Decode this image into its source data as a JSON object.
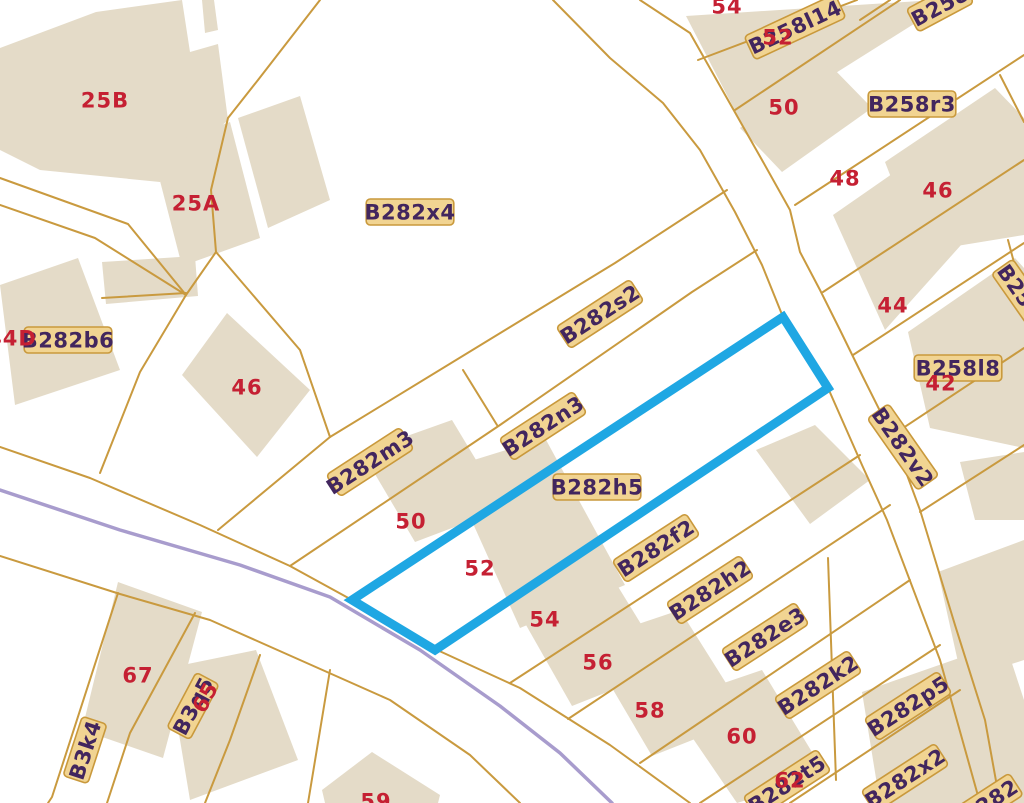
{
  "map": {
    "colors": {
      "background": "#ffffff",
      "building_fill": "#e4dbc8",
      "parcel_line": "#c99a3f",
      "stream_line": "#a89ccd",
      "selection_stroke": "#1fa7e3",
      "house_number": "#c52033",
      "label_text": "#42265e",
      "label_bg": "#f1d492",
      "label_border": "#c9993c"
    },
    "selection_outline": [
      [
        352,
        600
      ],
      [
        783,
        317
      ],
      [
        828,
        388
      ],
      [
        435,
        650
      ]
    ],
    "stream_path": [
      [
        0,
        490
      ],
      [
        120,
        530
      ],
      [
        240,
        565
      ],
      [
        330,
        597
      ],
      [
        420,
        650
      ],
      [
        500,
        706
      ],
      [
        560,
        753
      ],
      [
        612,
        803
      ]
    ],
    "parcel_lines": [
      [
        [
          553,
          0
        ],
        [
          610,
          58
        ],
        [
          663,
          103
        ],
        [
          700,
          150
        ],
        [
          735,
          212
        ],
        [
          762,
          265
        ],
        [
          783,
          317
        ]
      ],
      [
        [
          828,
          388
        ],
        [
          862,
          465
        ],
        [
          887,
          520
        ],
        [
          940,
          660
        ],
        [
          968,
          760
        ],
        [
          980,
          803
        ]
      ],
      [
        [
          640,
          0
        ],
        [
          690,
          33
        ],
        [
          762,
          160
        ],
        [
          790,
          210
        ],
        [
          800,
          252
        ],
        [
          820,
          290
        ],
        [
          840,
          330
        ],
        [
          863,
          377
        ],
        [
          893,
          437
        ],
        [
          920,
          510
        ],
        [
          955,
          625
        ],
        [
          985,
          720
        ],
        [
          1000,
          803
        ]
      ],
      [
        [
          0,
          447
        ],
        [
          90,
          478
        ],
        [
          200,
          525
        ],
        [
          290,
          566
        ],
        [
          352,
          600
        ],
        [
          435,
          649
        ],
        [
          520,
          688
        ],
        [
          610,
          745
        ],
        [
          690,
          803
        ]
      ],
      [
        [
          0,
          556
        ],
        [
          120,
          594
        ],
        [
          210,
          620
        ],
        [
          300,
          660
        ],
        [
          390,
          700
        ],
        [
          470,
          755
        ],
        [
          520,
          803
        ]
      ],
      [
        [
          320,
          0
        ],
        [
          258,
          80
        ],
        [
          228,
          118
        ],
        [
          211,
          190
        ],
        [
          216,
          252
        ],
        [
          186,
          295
        ],
        [
          140,
          372
        ],
        [
          100,
          473
        ]
      ],
      [
        [
          0,
          178
        ],
        [
          128,
          224
        ],
        [
          186,
          295
        ]
      ],
      [
        [
          0,
          205
        ],
        [
          95,
          238
        ],
        [
          186,
          295
        ]
      ],
      [
        [
          102,
          298
        ],
        [
          186,
          293
        ]
      ],
      [
        [
          218,
          530
        ],
        [
          330,
          437
        ],
        [
          615,
          263
        ],
        [
          727,
          190
        ]
      ],
      [
        [
          290,
          566
        ],
        [
          500,
          425
        ],
        [
          692,
          292
        ],
        [
          757,
          250
        ]
      ],
      [
        [
          463,
          370
        ],
        [
          497,
          425
        ]
      ],
      [
        [
          216,
          252
        ],
        [
          300,
          350
        ],
        [
          330,
          437
        ]
      ],
      [
        [
          510,
          683
        ],
        [
          860,
          455
        ]
      ],
      [
        [
          568,
          719
        ],
        [
          890,
          505
        ]
      ],
      [
        [
          640,
          763
        ],
        [
          910,
          580
        ]
      ],
      [
        [
          700,
          803
        ],
        [
          940,
          645
        ]
      ],
      [
        [
          790,
          803
        ],
        [
          960,
          690
        ]
      ],
      [
        [
          828,
          558
        ],
        [
          836,
          780
        ]
      ],
      [
        [
          860,
          20
        ],
        [
          890,
          0
        ]
      ],
      [
        [
          735,
          110
        ],
        [
          900,
          0
        ]
      ],
      [
        [
          698,
          60
        ],
        [
          857,
          0
        ]
      ],
      [
        [
          795,
          205
        ],
        [
          1024,
          55
        ]
      ],
      [
        [
          823,
          292
        ],
        [
          1024,
          160
        ]
      ],
      [
        [
          853,
          355
        ],
        [
          1024,
          243
        ]
      ],
      [
        [
          888,
          438
        ],
        [
          1024,
          348
        ]
      ],
      [
        [
          920,
          512
        ],
        [
          1024,
          445
        ]
      ],
      [
        [
          118,
          593
        ],
        [
          52,
          797
        ],
        [
          48,
          803
        ]
      ],
      [
        [
          195,
          613
        ],
        [
          130,
          733
        ],
        [
          107,
          803
        ]
      ],
      [
        [
          260,
          655
        ],
        [
          230,
          740
        ],
        [
          205,
          803
        ]
      ],
      [
        [
          330,
          670
        ],
        [
          308,
          803
        ]
      ],
      [
        [
          1000,
          75
        ],
        [
          1024,
          122
        ]
      ],
      [
        [
          1008,
          240
        ],
        [
          1024,
          300
        ]
      ]
    ],
    "buildings": [
      [
        [
          0,
          48
        ],
        [
          96,
          12
        ],
        [
          182,
          0
        ],
        [
          190,
          52
        ],
        [
          218,
          44
        ],
        [
          228,
          120
        ],
        [
          160,
          182
        ],
        [
          40,
          170
        ],
        [
          0,
          150
        ]
      ],
      [
        [
          202,
          0
        ],
        [
          214,
          0
        ],
        [
          218,
          30
        ],
        [
          205,
          33
        ]
      ],
      [
        [
          152,
          150
        ],
        [
          230,
          122
        ],
        [
          260,
          238
        ],
        [
          182,
          266
        ]
      ],
      [
        [
          238,
          118
        ],
        [
          300,
          96
        ],
        [
          330,
          200
        ],
        [
          268,
          228
        ]
      ],
      [
        [
          0,
          285
        ],
        [
          78,
          258
        ],
        [
          120,
          370
        ],
        [
          15,
          405
        ]
      ],
      [
        [
          102,
          262
        ],
        [
          195,
          256
        ],
        [
          198,
          296
        ],
        [
          106,
          304
        ]
      ],
      [
        [
          227,
          313
        ],
        [
          310,
          390
        ],
        [
          257,
          457
        ],
        [
          182,
          375
        ]
      ],
      [
        [
          362,
          452
        ],
        [
          452,
          420
        ],
        [
          505,
          508
        ],
        [
          415,
          542
        ]
      ],
      [
        [
          448,
          468
        ],
        [
          545,
          438
        ],
        [
          625,
          585
        ],
        [
          520,
          628
        ]
      ],
      [
        [
          505,
          588
        ],
        [
          598,
          554
        ],
        [
          668,
          668
        ],
        [
          572,
          706
        ]
      ],
      [
        [
          585,
          642
        ],
        [
          680,
          610
        ],
        [
          748,
          718
        ],
        [
          652,
          756
        ]
      ],
      [
        [
          668,
          702
        ],
        [
          762,
          670
        ],
        [
          826,
          775
        ],
        [
          737,
          803
        ]
      ],
      [
        [
          756,
          450
        ],
        [
          815,
          425
        ],
        [
          870,
          480
        ],
        [
          810,
          524
        ]
      ],
      [
        [
          686,
          16
        ],
        [
          935,
          0
        ],
        [
          952,
          0
        ],
        [
          745,
          130
        ]
      ],
      [
        [
          740,
          128
        ],
        [
          830,
          65
        ],
        [
          872,
          108
        ],
        [
          782,
          172
        ]
      ],
      [
        [
          885,
          162
        ],
        [
          995,
          88
        ],
        [
          1024,
          118
        ],
        [
          1024,
          235
        ],
        [
          920,
          252
        ]
      ],
      [
        [
          833,
          215
        ],
        [
          958,
          128
        ],
        [
          1012,
          188
        ],
        [
          885,
          330
        ]
      ],
      [
        [
          908,
          332
        ],
        [
          1015,
          258
        ],
        [
          1024,
          268
        ],
        [
          1024,
          448
        ],
        [
          930,
          428
        ]
      ],
      [
        [
          960,
          462
        ],
        [
          1024,
          452
        ],
        [
          1024,
          520
        ],
        [
          975,
          520
        ]
      ],
      [
        [
          938,
          572
        ],
        [
          1024,
          540
        ],
        [
          1024,
          660
        ],
        [
          962,
          680
        ]
      ],
      [
        [
          862,
          692
        ],
        [
          1005,
          642
        ],
        [
          1024,
          700
        ],
        [
          1024,
          803
        ],
        [
          880,
          803
        ]
      ],
      [
        [
          118,
          582
        ],
        [
          202,
          612
        ],
        [
          163,
          758
        ],
        [
          82,
          730
        ]
      ],
      [
        [
          168,
          668
        ],
        [
          256,
          650
        ],
        [
          298,
          760
        ],
        [
          190,
          800
        ]
      ],
      [
        [
          322,
          790
        ],
        [
          372,
          752
        ],
        [
          440,
          795
        ],
        [
          438,
          803
        ],
        [
          325,
          803
        ]
      ]
    ],
    "parcel_labels": [
      {
        "text": "B282x4",
        "x": 410,
        "y": 212,
        "rot": 0
      },
      {
        "text": "B282s2",
        "x": 600,
        "y": 314,
        "rot": -33
      },
      {
        "text": "B282n3",
        "x": 543,
        "y": 426,
        "rot": -33
      },
      {
        "text": "B282m3",
        "x": 370,
        "y": 462,
        "rot": -33
      },
      {
        "text": "B282h5",
        "x": 597,
        "y": 487,
        "rot": 0
      },
      {
        "text": "B282f2",
        "x": 656,
        "y": 548,
        "rot": -33
      },
      {
        "text": "B282h2",
        "x": 710,
        "y": 590,
        "rot": -33
      },
      {
        "text": "B282e3",
        "x": 765,
        "y": 637,
        "rot": -33
      },
      {
        "text": "B282k2",
        "x": 818,
        "y": 685,
        "rot": -33
      },
      {
        "text": "B282p5",
        "x": 908,
        "y": 706,
        "rot": -33
      },
      {
        "text": "B282x2",
        "x": 905,
        "y": 778,
        "rot": -33
      },
      {
        "text": "B282t5",
        "x": 787,
        "y": 784,
        "rot": -33
      },
      {
        "text": "B282b6",
        "x": 68,
        "y": 340,
        "rot": 0
      },
      {
        "text": "B282v2",
        "x": 903,
        "y": 447,
        "rot": 55
      },
      {
        "text": "B258l14",
        "x": 795,
        "y": 27,
        "rot": -25
      },
      {
        "text": "B258r3",
        "x": 912,
        "y": 104,
        "rot": 0
      },
      {
        "text": "B258l8",
        "x": 958,
        "y": 368,
        "rot": 0
      },
      {
        "text": "B258",
        "x": 940,
        "y": 6,
        "rot": -28
      },
      {
        "text": "B258",
        "x": 1020,
        "y": 292,
        "rot": 55
      },
      {
        "text": "B282",
        "x": 990,
        "y": 801,
        "rot": -33
      },
      {
        "text": "B3k4",
        "x": 85,
        "y": 750,
        "rot": -72
      },
      {
        "text": "B3q5",
        "x": 193,
        "y": 706,
        "rot": -62
      }
    ],
    "house_numbers": [
      {
        "text": "25B",
        "x": 105,
        "y": 100,
        "rot": 0
      },
      {
        "text": "25A",
        "x": 196,
        "y": 203,
        "rot": 0
      },
      {
        "text": "44D",
        "x": 12,
        "y": 338,
        "rot": 0
      },
      {
        "text": "46",
        "x": 247,
        "y": 387,
        "rot": 0
      },
      {
        "text": "50",
        "x": 411,
        "y": 521,
        "rot": 0
      },
      {
        "text": "52",
        "x": 480,
        "y": 568,
        "rot": 0
      },
      {
        "text": "54",
        "x": 545,
        "y": 619,
        "rot": 0
      },
      {
        "text": "56",
        "x": 598,
        "y": 662,
        "rot": 0
      },
      {
        "text": "58",
        "x": 650,
        "y": 710,
        "rot": 0
      },
      {
        "text": "60",
        "x": 742,
        "y": 736,
        "rot": 0
      },
      {
        "text": "62",
        "x": 790,
        "y": 780,
        "rot": 0
      },
      {
        "text": "67",
        "x": 138,
        "y": 675,
        "rot": 0
      },
      {
        "text": "65",
        "x": 205,
        "y": 697,
        "rot": -62
      },
      {
        "text": "59",
        "x": 376,
        "y": 801,
        "rot": 0
      },
      {
        "text": "54",
        "x": 727,
        "y": 6,
        "rot": 0
      },
      {
        "text": "52",
        "x": 778,
        "y": 37,
        "rot": 0
      },
      {
        "text": "50",
        "x": 784,
        "y": 107,
        "rot": 0
      },
      {
        "text": "48",
        "x": 845,
        "y": 178,
        "rot": 0
      },
      {
        "text": "46",
        "x": 938,
        "y": 190,
        "rot": 0
      },
      {
        "text": "44",
        "x": 893,
        "y": 305,
        "rot": 0
      },
      {
        "text": "42",
        "x": 941,
        "y": 383,
        "rot": 0
      }
    ]
  }
}
